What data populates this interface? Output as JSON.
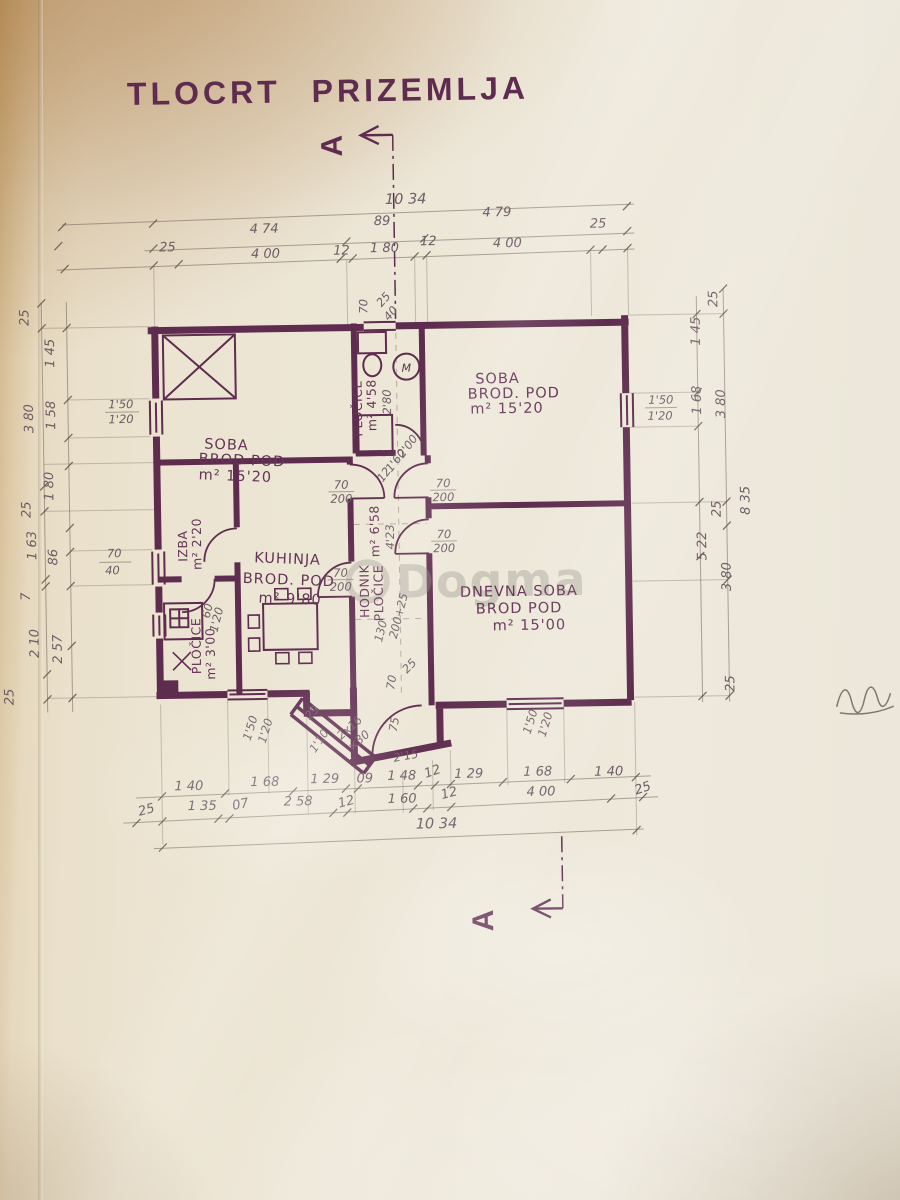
{
  "page": {
    "title": "TLOCRT PRIZEMLJA"
  },
  "section": {
    "label": "A"
  },
  "watermark": {
    "text": "Dogma"
  },
  "colors": {
    "ink": "#5e2c4e",
    "pencil": "#6e6058",
    "paper": "#ece4d2"
  },
  "rooms": {
    "soba_left": {
      "name": "SOBA",
      "floor": "BROD POD",
      "area": "m² 15'20"
    },
    "soba_right": {
      "name": "SOBA",
      "floor": "BROD. POD",
      "area": "m² 15'20"
    },
    "kuhinja": {
      "name": "KUHINJA",
      "floor": "BROD. POD",
      "area": "m² 9'80"
    },
    "dnevna_soba": {
      "name": "DNEVNA SOBA",
      "floor": "BROD POD",
      "area": "m² 15'00"
    },
    "izba": {
      "name": "IZBA",
      "area": "m² 2'20"
    },
    "spajz": {
      "name": "PLOČICE",
      "area": "m² 3'00"
    },
    "kupaonica": {
      "name": "PLOČICE",
      "area": "m² 4'58",
      "depth": "2'80"
    },
    "hodnik": {
      "name": "HODNIK",
      "floor": "PLOČICE",
      "area": "m² 6'58",
      "length": "4'23"
    }
  },
  "fixtures": {
    "washer": "M"
  },
  "dims": {
    "top_total": "10 34",
    "top_mid": [
      "4 74",
      "89",
      "4 79"
    ],
    "top_detail": [
      "25",
      "4 00",
      "12",
      "1 80",
      "12",
      "4 00",
      "25"
    ],
    "left_outer": [
      "25",
      "3 80",
      "25",
      "1 63",
      "7",
      "2 10",
      "25"
    ],
    "left_inner": [
      "1 45",
      "1 58",
      "1 80",
      "86",
      "2 57"
    ],
    "right_inner": [
      "1 45",
      "1 68",
      "5 22"
    ],
    "right_outer": [
      "25",
      "3 80",
      "25",
      "8 35",
      "3 80",
      "25"
    ],
    "bottom_mid": [
      "1 40",
      "1 68",
      "1 29",
      "09",
      "1 48",
      "12",
      "1 29",
      "1 68",
      "1 40"
    ],
    "bottom_detail": [
      "25",
      "1 35",
      "07",
      "2 58",
      "12",
      "1 60",
      "12",
      "4 00",
      "25"
    ],
    "bottom_total": "10 34",
    "window_left": [
      "1'50",
      "1'20"
    ],
    "window_small": [
      "70",
      "40"
    ],
    "window_right": [
      "1'50",
      "1'20"
    ],
    "window_bottom_left": [
      "1'50",
      "1'20"
    ],
    "window_bottom_right": [
      "1'50",
      "1'20"
    ],
    "window_spajz": [
      "60",
      "1'20"
    ],
    "door": [
      "70",
      "200"
    ],
    "door_glass": [
      "12",
      "1'60",
      "2'00"
    ],
    "entry_door": [
      "130",
      "200+25"
    ],
    "vent": [
      "70",
      "25",
      "40"
    ],
    "steps": {
      "count": "2x16",
      "tread": "×30",
      "length": "2'15",
      "width": "1'10",
      "a": "75",
      "b": "70",
      "c": "25",
      "d": "29"
    }
  }
}
